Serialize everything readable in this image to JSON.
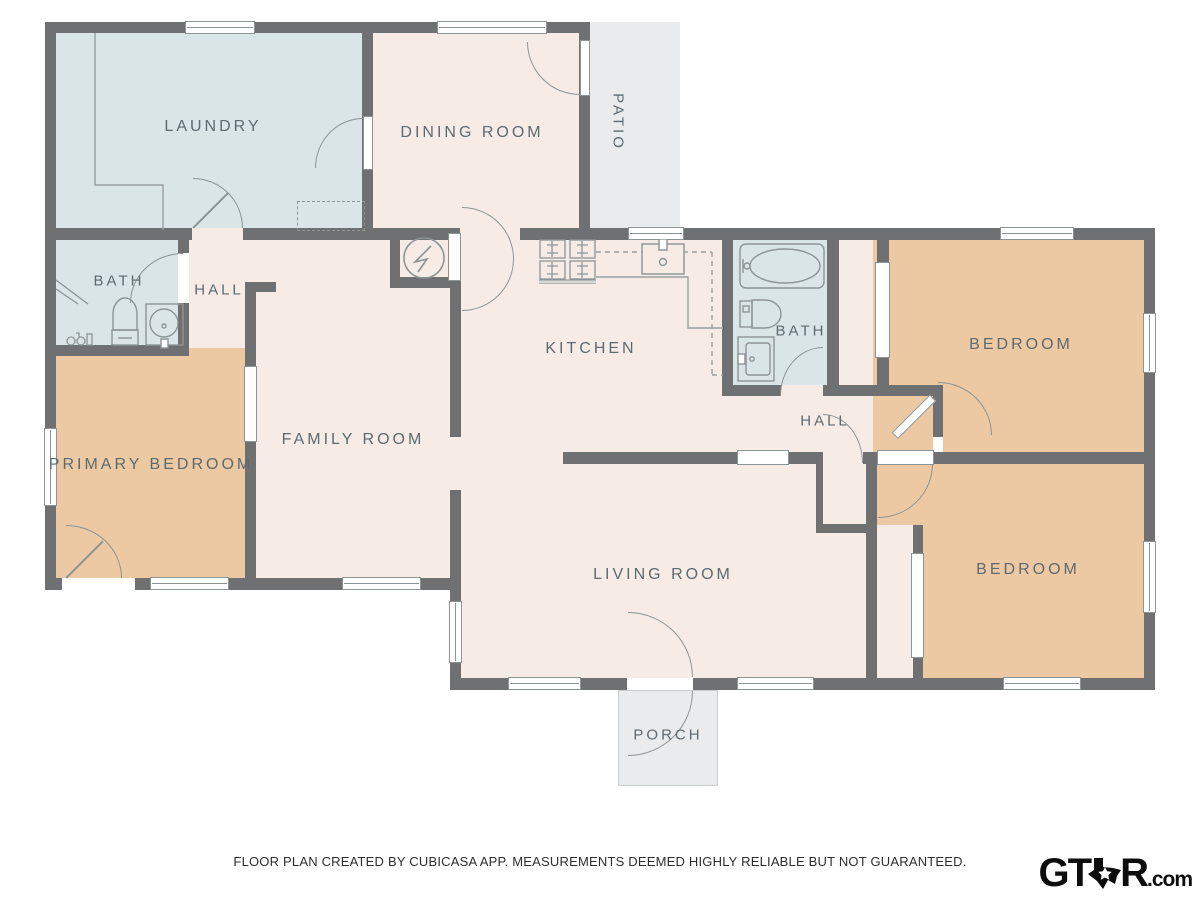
{
  "plan": {
    "rooms": {
      "laundry": {
        "label": "LAUNDRY"
      },
      "dining_room": {
        "label": "DINING ROOM"
      },
      "patio": {
        "label": "PATIO"
      },
      "bath1": {
        "label": "BATH"
      },
      "hall1": {
        "label": "HALL"
      },
      "kitchen": {
        "label": "KITCHEN"
      },
      "bath2": {
        "label": "BATH"
      },
      "hall2": {
        "label": "HALL"
      },
      "bedroom1": {
        "label": "BEDROOM"
      },
      "primary_bedroom": {
        "label": "PRIMARY BEDROOM"
      },
      "family_room": {
        "label": "FAMILY ROOM"
      },
      "living_room": {
        "label": "LIVING ROOM"
      },
      "bedroom2": {
        "label": "BEDROOM"
      },
      "porch": {
        "label": "PORCH"
      }
    },
    "colors": {
      "wall": "#6e7071",
      "room_cream": "#f6ece5",
      "room_wet": "#d9e5e6",
      "room_bedroom": "#ecc9a3",
      "outdoor": "#e9ebec",
      "label_text": "#5d6a71",
      "fixture_line": "#8d9496"
    },
    "icons": [
      "water-heater-icon",
      "stove-icon",
      "kitchen-sink-icon",
      "bathtub-icon",
      "toilet-icon",
      "round-sink-icon",
      "vanity-sink-icon",
      "shower-icon",
      "faucet-icon"
    ]
  },
  "footer": {
    "disclaimer": "FLOOR PLAN CREATED BY CUBICASA APP. MEASUREMENTS DEEMED HIGHLY RELIABLE BUT NOT GUARANTEED."
  },
  "logo": {
    "name_left": "GT",
    "name_right": "R",
    "suffix": ".com"
  }
}
